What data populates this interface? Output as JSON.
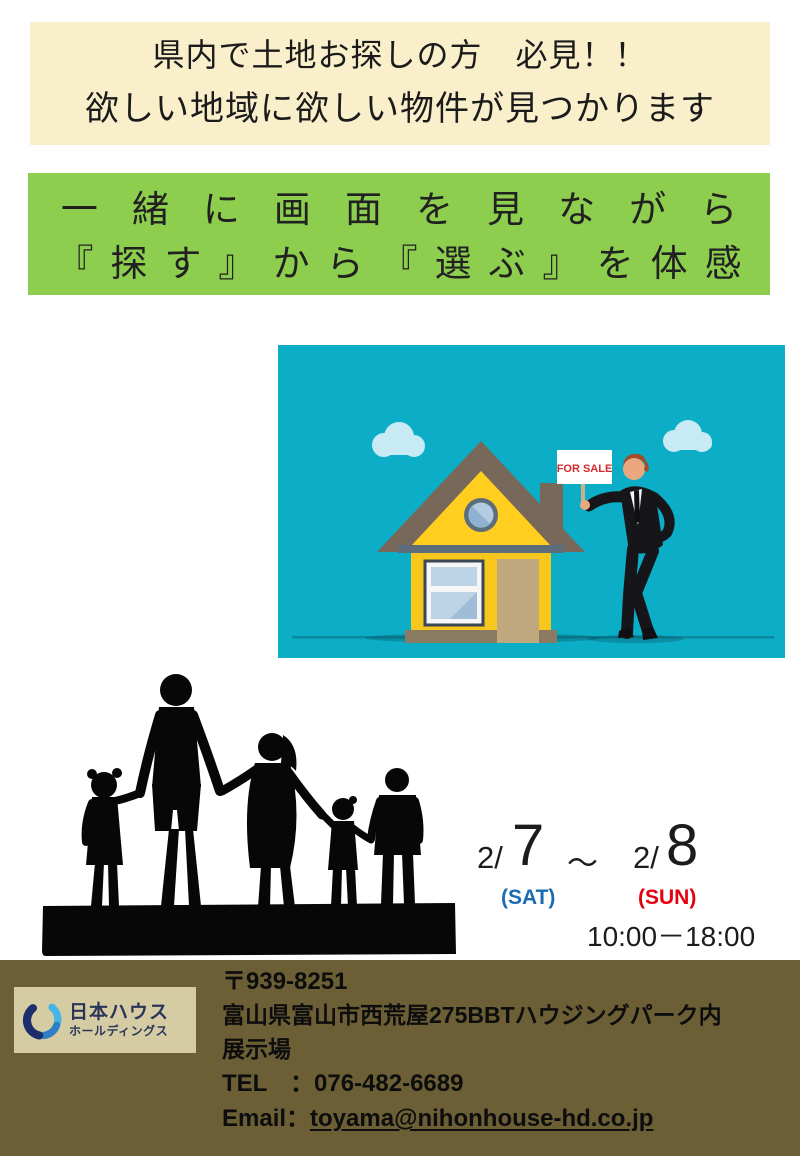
{
  "headline": {
    "line1": "県内で土地お探しの方　必見！！",
    "line2": "欲しい地域に欲しい物件が見つかります"
  },
  "subheadline": {
    "line1": "一緒に画面を見ながら",
    "line2": "『探す』から『選ぶ』を体感"
  },
  "illustration": {
    "sign_text": "FOR SALE",
    "description": "man in black suit holding for-sale sign beside yellow house"
  },
  "event": {
    "date1_prefix": "2/",
    "date1_day": "7",
    "separator": "～",
    "date2_prefix": "2/",
    "date2_day": "8",
    "date1_label": "(SAT)",
    "date2_label": "(SUN)",
    "hours": "10:00－18:00"
  },
  "footer": {
    "logo": {
      "line1": "日本ハウス",
      "line2": "ホールディングス"
    },
    "postal": "〒939-8251",
    "address_line1": "富山県富山市西荒屋275BBTハウジングパーク内",
    "address_line2": "展示場",
    "tel_label": "TEL",
    "tel_sep": "：",
    "tel_number": "076-482-6689",
    "email_label": "Email",
    "email_sep": "：",
    "email_address": "toyama@nihonhouse-hd.co.jp"
  },
  "colors": {
    "headline_bg": "#F9EFCB",
    "subheadline_bg": "#8DCE4E",
    "illustration_bg": "#0BAEC6",
    "footer_bg": "#6C5F35",
    "logo_box_bg": "#D6CCA4",
    "sat_blue": "#1B6BB0",
    "sun_red": "#E3000F",
    "sign_red": "#D42B2B",
    "house_yellow": "#F7C71D",
    "roof_brown": "#77685A"
  }
}
